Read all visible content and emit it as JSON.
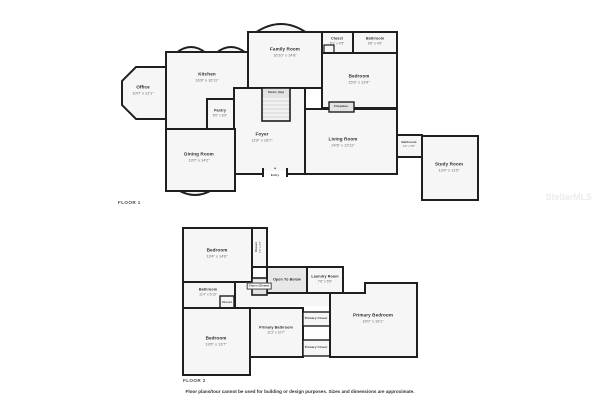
{
  "watermark": "StellarMLS",
  "disclaimer": "Floor plans/tour cannot be used for building or design purposes. Sizes and dimensions are approximate.",
  "colors": {
    "wall": "#1f1f1f",
    "room_fill": "#f6f6f6",
    "shaded_fill": "#e3e3e3",
    "background": "#ffffff"
  },
  "floor1": {
    "label": "FLOOR 1",
    "rooms": {
      "office": {
        "name": "Office",
        "dims": "10'0\" x 12'1\""
      },
      "kitchen": {
        "name": "Kitchen",
        "dims": "16'8\" x 16'11\""
      },
      "pantry": {
        "name": "Pantry",
        "dims": "5'0\" x 6'0\""
      },
      "family_room": {
        "name": "Family Room",
        "dims": "16'10\" x 14'8\""
      },
      "closet": {
        "name": "Closet",
        "dims": "6'1\" x 4'5\""
      },
      "bathroom": {
        "name": "Bathroom",
        "dims": "9'6\" x 4'9\""
      },
      "bedroom": {
        "name": "Bedroom",
        "dims": "15'3\" x 13'4\""
      },
      "fireplace": {
        "name": "Fireplace"
      },
      "stairs": {
        "name": "Stairs (Up)"
      },
      "foyer": {
        "name": "Foyer",
        "dims": "11'8\" x 16'7\""
      },
      "dining_room": {
        "name": "Dining Room",
        "dims": "13'0\" x 14'2\""
      },
      "living_room": {
        "name": "Living Room",
        "dims": "24'6\" x 13'11\""
      },
      "bathroom_small": {
        "name": "Bathroom",
        "dims": "4'6\" x 5'8\""
      },
      "study_room": {
        "name": "Study Room",
        "dims": "13'4\" x 11'5\""
      },
      "entry": {
        "name": "Entry"
      }
    }
  },
  "floor2": {
    "label": "FLOOR 2",
    "rooms": {
      "bedroom_top": {
        "name": "Bedroom",
        "dims": "13'4\" x 14'6\""
      },
      "closet_tall": {
        "name": "Closet",
        "dims": "2'5\" x 8'6\""
      },
      "open_to_below": {
        "name": "Open To Below"
      },
      "stairs": {
        "name": "Stairs (Down)"
      },
      "laundry_room": {
        "name": "Laundry Room",
        "dims": "7'6\" x 5'9\""
      },
      "bathroom": {
        "name": "Bathroom",
        "dims": "11'4\" x 5'10\""
      },
      "closet_small": {
        "name": "Closet"
      },
      "bedroom_bottom": {
        "name": "Bedroom",
        "dims": "13'6\" x 13'7\""
      },
      "primary_bathroom": {
        "name": "Primary Bathroom",
        "dims": "11'3\" x 10'7\""
      },
      "primary_closet_top": {
        "name": "Primary Closet"
      },
      "primary_closet_bottom": {
        "name": "Primary Closet"
      },
      "primary_bedroom": {
        "name": "Primary Bedroom",
        "dims": "16'0\" x 16'1\""
      }
    }
  }
}
